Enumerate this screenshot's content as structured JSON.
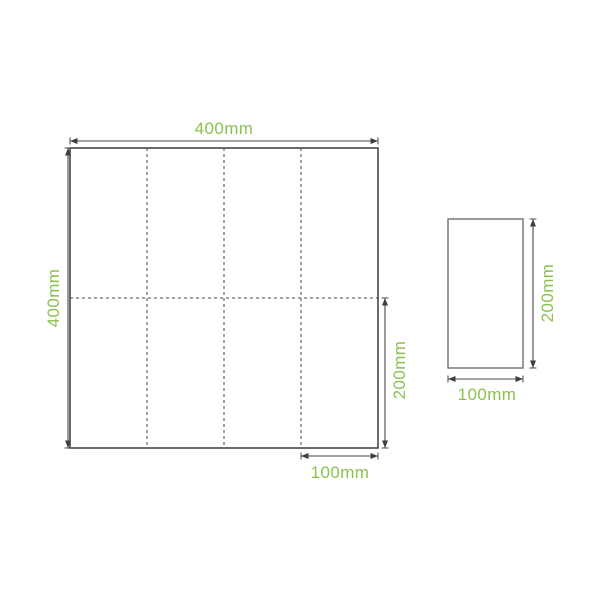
{
  "colors": {
    "label_green": "#8CC04C",
    "outline_dark": "#3A3A3A",
    "outline_gray": "#707070",
    "dimension_line": "#4A4A4A",
    "background": "#FFFFFF"
  },
  "unfolded_sheet": {
    "width_label": "400mm",
    "height_label": "400mm",
    "half_height_label": "200mm",
    "panel_width_label": "100mm",
    "vertical_fold_lines": 3,
    "horizontal_fold_lines": 1,
    "fold_panels_across": 4,
    "fold_panels_down": 2
  },
  "folded_sheet": {
    "height_label": "200mm",
    "width_label": "100mm"
  }
}
